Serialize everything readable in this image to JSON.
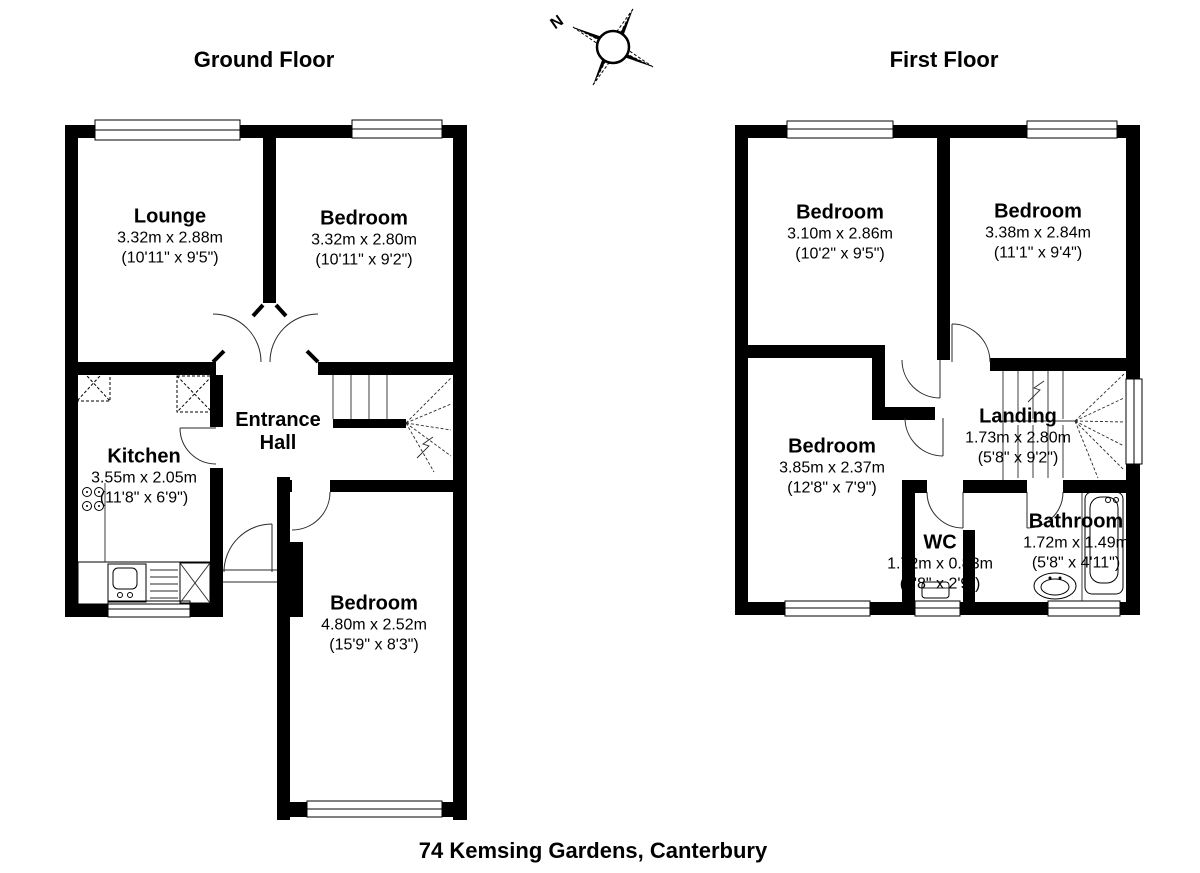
{
  "ground_floor": {
    "title": "Ground Floor",
    "rooms": {
      "lounge": {
        "name": "Lounge",
        "metric": "3.32m x 2.88m",
        "imperial": "(10'11\" x 9'5\")"
      },
      "bedroom_front": {
        "name": "Bedroom",
        "metric": "3.32m x 2.80m",
        "imperial": "(10'11\" x 9'2\")"
      },
      "kitchen": {
        "name": "Kitchen",
        "metric": "3.55m x 2.05m",
        "imperial": "(11'8\" x 6'9\")"
      },
      "entrance_hall": {
        "name": "Entrance Hall"
      },
      "bedroom_rear": {
        "name": "Bedroom",
        "metric": "4.80m x 2.52m",
        "imperial": "(15'9\" x 8'3\")"
      }
    }
  },
  "first_floor": {
    "title": "First Floor",
    "rooms": {
      "bedroom_left": {
        "name": "Bedroom",
        "metric": "3.10m x 2.86m",
        "imperial": "(10'2\" x 9'5\")"
      },
      "bedroom_right": {
        "name": "Bedroom",
        "metric": "3.38m x 2.84m",
        "imperial": "(11'1\" x 9'4\")"
      },
      "bedroom_back": {
        "name": "Bedroom",
        "metric": "3.85m x 2.37m",
        "imperial": "(12'8\" x 7'9\")"
      },
      "landing": {
        "name": "Landing",
        "metric": "1.73m x 2.80m",
        "imperial": "(5'8\" x 9'2\")"
      },
      "wc": {
        "name": "WC",
        "metric": "1.72m x 0.83m",
        "imperial": "(5'8\" x 2'9\")"
      },
      "bathroom": {
        "name": "Bathroom",
        "metric": "1.72m x 1.49m",
        "imperial": "(5'8\" x 4'11\")"
      }
    }
  },
  "compass": {
    "north_label": "N"
  },
  "footer": {
    "address": "74 Kemsing Gardens, Canterbury"
  }
}
